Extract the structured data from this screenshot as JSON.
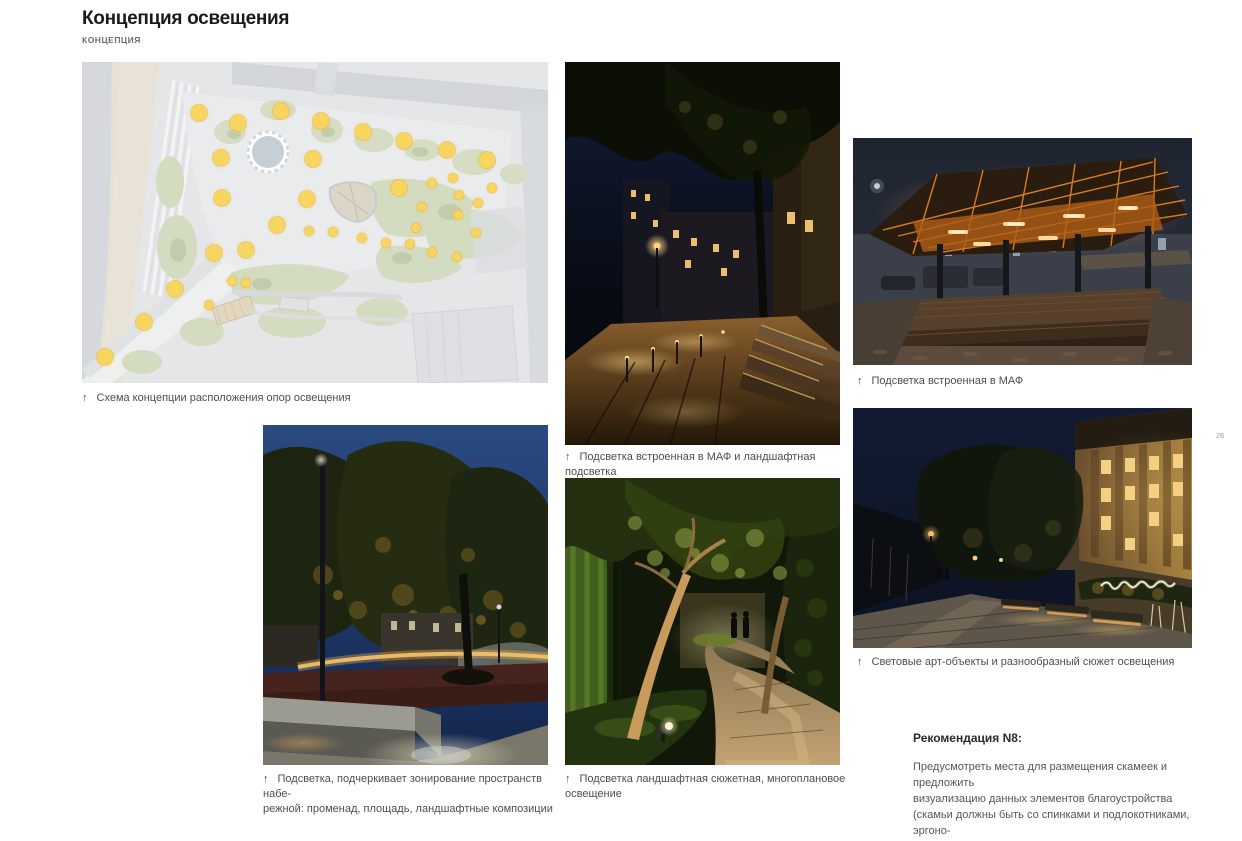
{
  "page": {
    "title": "Концепция освещения",
    "subtitle": "КОНЦЕПЦИЯ",
    "page_number": "26"
  },
  "icons": {
    "up_arrow": "↑"
  },
  "colors": {
    "accent_dot": "#f8d55f",
    "caption_text": "#4d4e50",
    "plan_background": "#dadde0"
  },
  "site_plan": {
    "caption": "Схема концепции расположения опор освещения",
    "dot_color": "#f8d55f",
    "dots_large": [
      [
        25.1,
        16.0
      ],
      [
        33.4,
        19.1
      ],
      [
        42.6,
        15.4
      ],
      [
        51.3,
        18.5
      ],
      [
        60.2,
        21.8
      ],
      [
        69.1,
        24.6
      ],
      [
        78.3,
        27.4
      ],
      [
        87.0,
        30.5
      ],
      [
        29.8,
        29.8
      ],
      [
        49.6,
        30.2
      ],
      [
        68.1,
        39.1
      ],
      [
        30.0,
        42.5
      ],
      [
        48.3,
        42.8
      ],
      [
        41.9,
        50.8
      ],
      [
        35.1,
        58.5
      ],
      [
        28.3,
        59.4
      ],
      [
        20.0,
        70.8
      ],
      [
        13.4,
        80.9
      ],
      [
        4.9,
        92.0
      ]
    ],
    "dots_small": [
      [
        48.7,
        52.6
      ],
      [
        53.8,
        52.9
      ],
      [
        60.0,
        54.8
      ],
      [
        65.3,
        56.3
      ],
      [
        70.4,
        56.6
      ],
      [
        71.7,
        51.7
      ],
      [
        75.1,
        59.1
      ],
      [
        80.4,
        60.6
      ],
      [
        84.5,
        53.2
      ],
      [
        73.0,
        45.2
      ],
      [
        75.1,
        37.8
      ],
      [
        79.6,
        36.0
      ],
      [
        80.9,
        41.5
      ],
      [
        80.6,
        47.7
      ],
      [
        84.9,
        44.0
      ],
      [
        87.9,
        39.1
      ],
      [
        32.1,
        68.3
      ],
      [
        35.3,
        68.9
      ],
      [
        27.2,
        75.7
      ]
    ]
  },
  "photos": [
    {
      "id": "promenade-maf",
      "caption": "Подсветка встроенная в МАФ и ландшафтная подсветка"
    },
    {
      "id": "pavilion-maf",
      "caption": "Подсветка встроенная в МАФ"
    },
    {
      "id": "zoning-lighting",
      "caption": "Подсветка, подчеркивает зонирование пространств набе-\nрежной: променад, площадь, ландшафтные композиции"
    },
    {
      "id": "landscape-scenic",
      "caption": "Подсветка ландшафтная сюжетная, многоплановое\nосвещение"
    },
    {
      "id": "art-objects",
      "caption": "Световые арт-объекты и разнообразный сюжет освещения"
    }
  ],
  "recommendation": {
    "title": "Рекомендация N8:",
    "body": "Предусмотреть места для размещения скамеек и предложить\nвизуализацию данных элементов благоустройства\n(скамьи должны быть со спинками и подлокотниками, эргоно-\nмичными, удобными для использования пожилыми людьми)."
  }
}
